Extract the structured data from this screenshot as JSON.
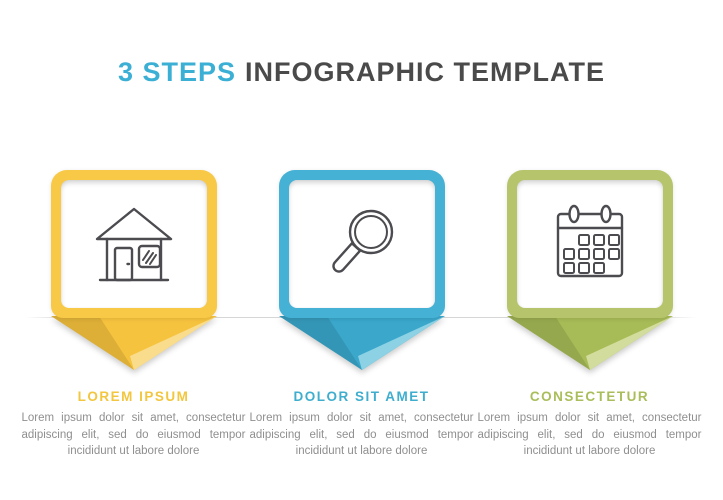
{
  "title": {
    "highlight": "3 STEPS",
    "rest": "INFOGRAPHIC TEMPLATE"
  },
  "palette": {
    "title-accent": "#3CAFD4",
    "title-main": "#4A4A4A",
    "body-text": "#8F8F8F",
    "divider": "#D6D6D6",
    "icon-stroke": "#4B4B50"
  },
  "steps": [
    {
      "index": "1",
      "icon": "house-icon",
      "heading": "LOREM IPSUM",
      "description": "Lorem ipsum dolor sit amet, consectetur adipiscing elit, sed do eiusmod tempor incididunt ut labore dolore",
      "colors": {
        "square": "#F8C847",
        "tri": "#F6C33E",
        "facet": "#F9DC8C",
        "heading": "#F2C63F"
      }
    },
    {
      "index": "2",
      "icon": "magnifier-icon",
      "heading": "DOLOR SIT AMET",
      "description": "Lorem ipsum dolor sit amet, consectetur adipiscing elit, sed do eiusmod tempor incididunt ut labore dolore",
      "colors": {
        "square": "#45B1D4",
        "tri": "#3AA7CB",
        "facet": "#8CD1E4",
        "heading": "#3FAECE"
      }
    },
    {
      "index": "3",
      "icon": "calendar-icon",
      "heading": "CONSECTETUR",
      "description": "Lorem ipsum dolor sit amet, consectetur adipiscing elit, sed do eiusmod tempor incididunt ut labore dolore",
      "colors": {
        "square": "#B6C46C",
        "tri": "#A7BB57",
        "facet": "#D2DC9C",
        "heading": "#A9BE5A"
      }
    }
  ]
}
